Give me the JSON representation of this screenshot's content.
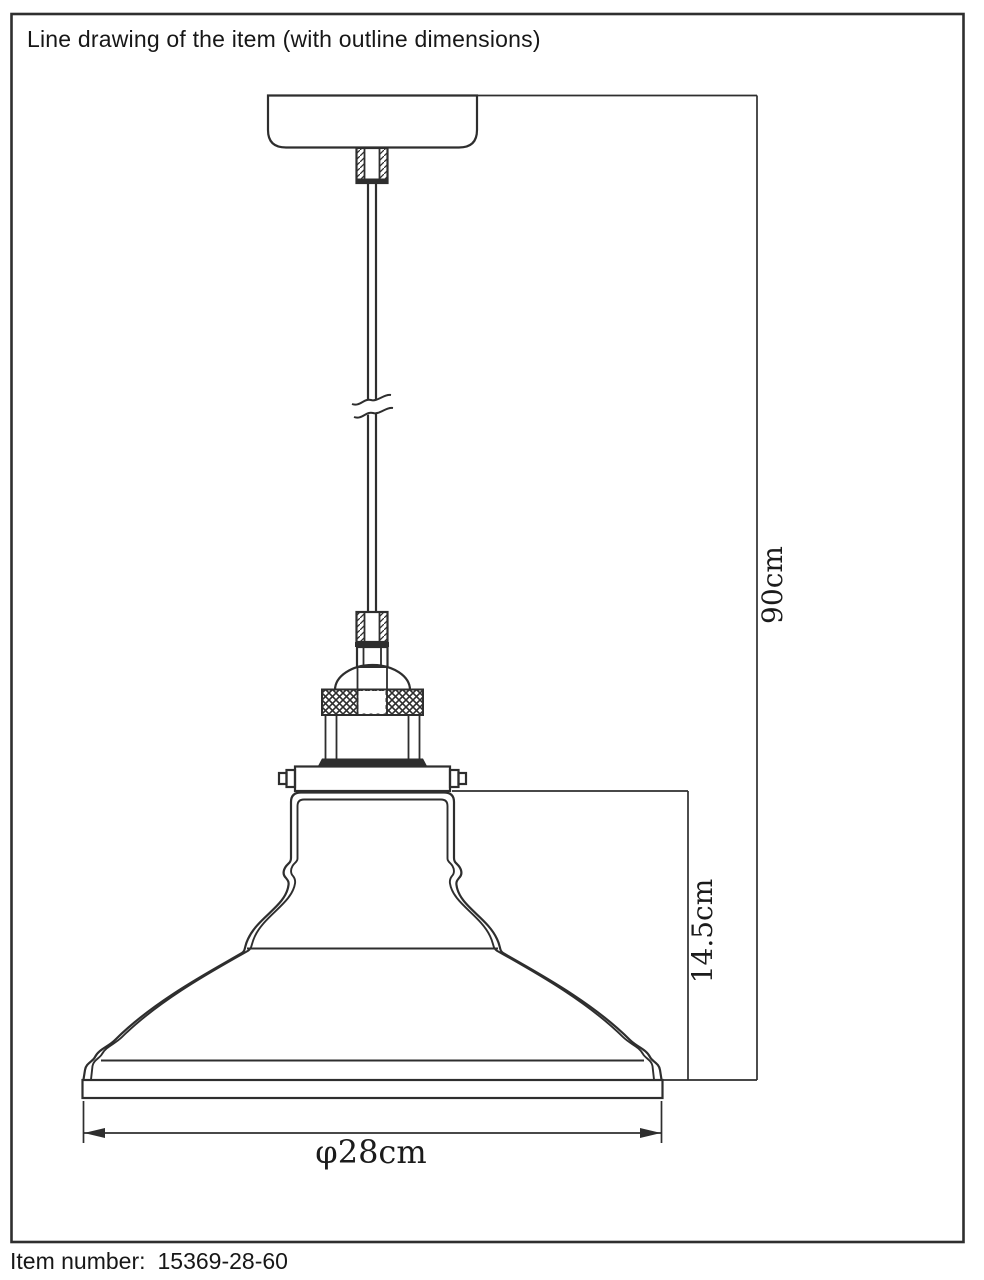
{
  "header": {
    "title": "Line drawing of the item (with outline dimensions)"
  },
  "footer": {
    "item_number_label": "Item number:",
    "item_number_value": "15369-28-60"
  },
  "drawing": {
    "subject": "pendant-lamp-technical-line-drawing",
    "components": [
      "ceiling-canopy",
      "cord-grip",
      "suspension-cord",
      "cord-break-symbol",
      "lamp-socket",
      "knurled-ring",
      "shade-mounting-bracket",
      "dome-lamp-shade"
    ],
    "dimension_labels": {
      "overall_height": "90cm",
      "shade_height": "14.5cm",
      "shade_diameter": "φ28cm"
    },
    "colors": {
      "line": "#2e2e2e",
      "background": "#ffffff",
      "text": "#1b1b1b"
    }
  }
}
